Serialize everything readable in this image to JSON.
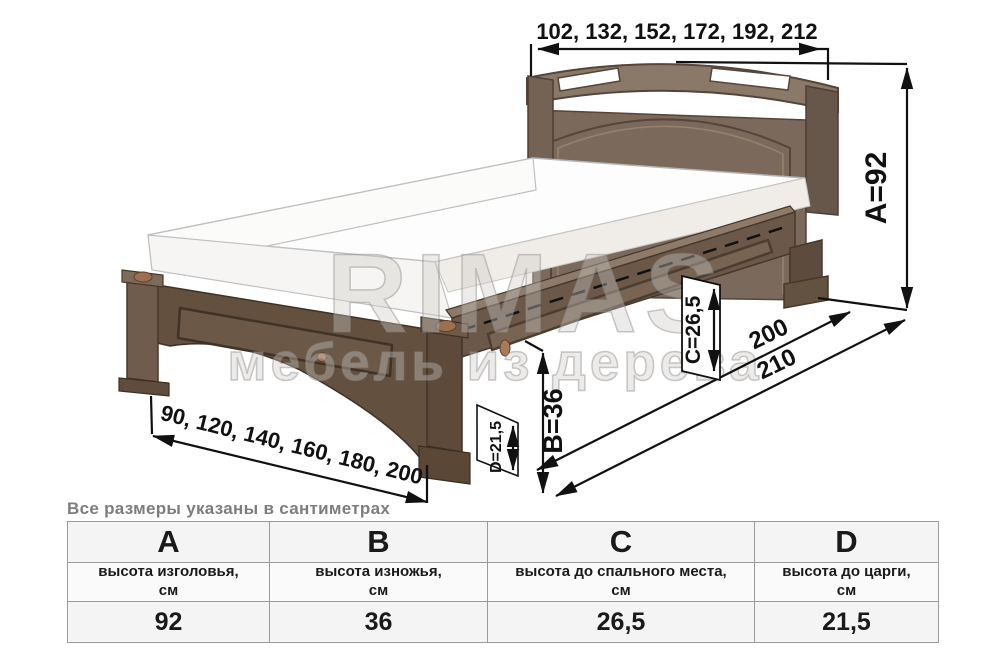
{
  "diagram": {
    "watermark_line1": "RIMAS",
    "watermark_line2": "мебель из дерева",
    "dim_headboard_widths": "102, 132, 152, 172, 192, 212",
    "dim_height_a": "А=92",
    "dim_length_inner": "200",
    "dim_length_outer": "210",
    "dim_height_c": "С=26,5",
    "dim_height_b": "В=36",
    "dim_height_d": "D=21,5",
    "dim_footboard_widths": "90, 120, 140, 160, 180, 200"
  },
  "note": "Все размеры указаны в сантиметрах",
  "table": {
    "columns": [
      {
        "letter": "A",
        "description": "высота изголовья,",
        "unit": "см",
        "value": "92"
      },
      {
        "letter": "B",
        "description": "высота изножья,",
        "unit": "см",
        "value": "36"
      },
      {
        "letter": "C",
        "description": "высота до спального места,",
        "unit": "см",
        "value": "26,5"
      },
      {
        "letter": "D",
        "description": "высота до царги,",
        "unit": "см",
        "value": "21,5"
      }
    ]
  },
  "colors": {
    "wood_dark": "#5d4a3a",
    "wood_mid": "#6d5a4a",
    "wood_light": "#8a7866",
    "accent_copper": "#9b7050",
    "dimension_lines": "#111111",
    "note_gray": "#7d7d7d",
    "table_bg": "#f4f4f4"
  }
}
